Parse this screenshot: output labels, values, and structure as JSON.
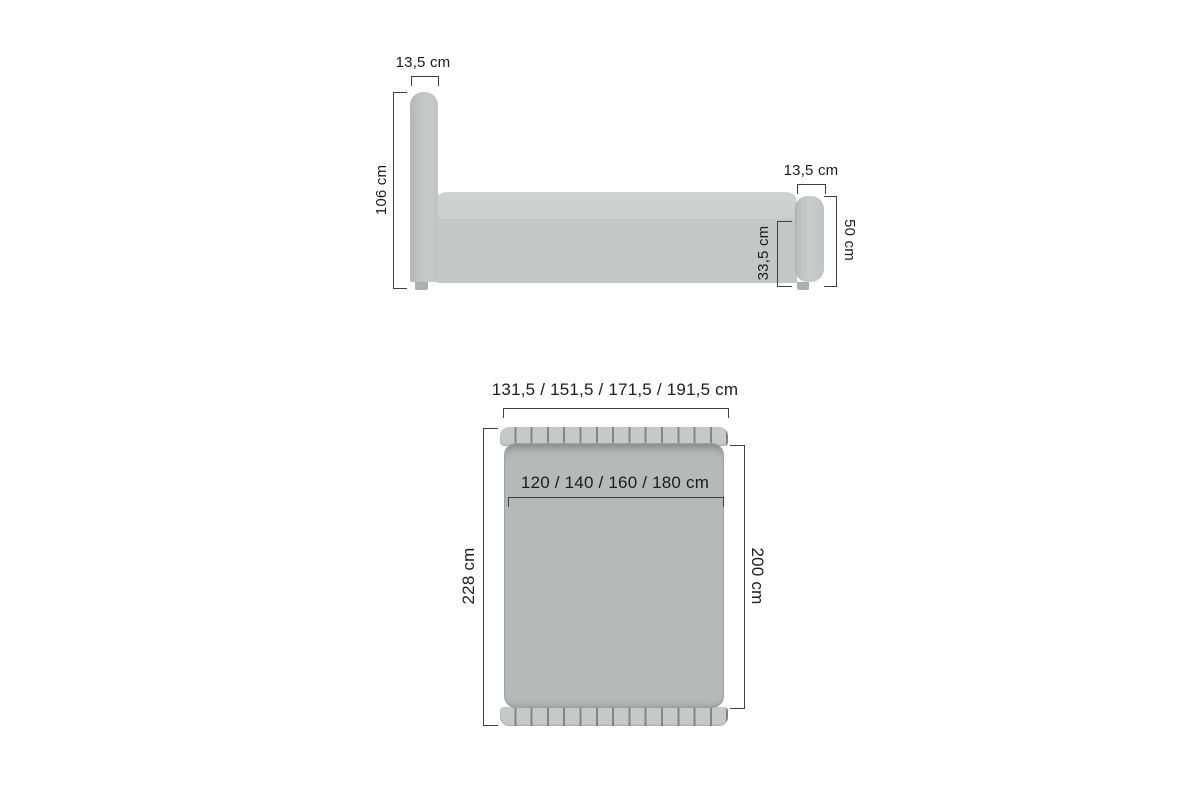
{
  "side_view": {
    "headboard_width_label": "13,5 cm",
    "headboard_height_label": "106 cm",
    "footboard_width_label": "13,5 cm",
    "footboard_height_label": "50 cm",
    "base_height_label": "33,5 cm"
  },
  "top_view": {
    "overall_width_label": "131,5 / 151,5 / 171,5 / 191,5 cm",
    "mattress_width_label": "120 / 140 / 160 / 180  cm",
    "overall_length_label": "228 cm",
    "mattress_length_label": "200 cm"
  },
  "colors": {
    "background": "#ffffff",
    "upholstery_light": "#cdcfce",
    "upholstery_mid": "#c5c7c6",
    "mattress_top_view": "#b7b9b8",
    "dimension_line": "#3f4140",
    "label_text": "#1c1c1c"
  }
}
